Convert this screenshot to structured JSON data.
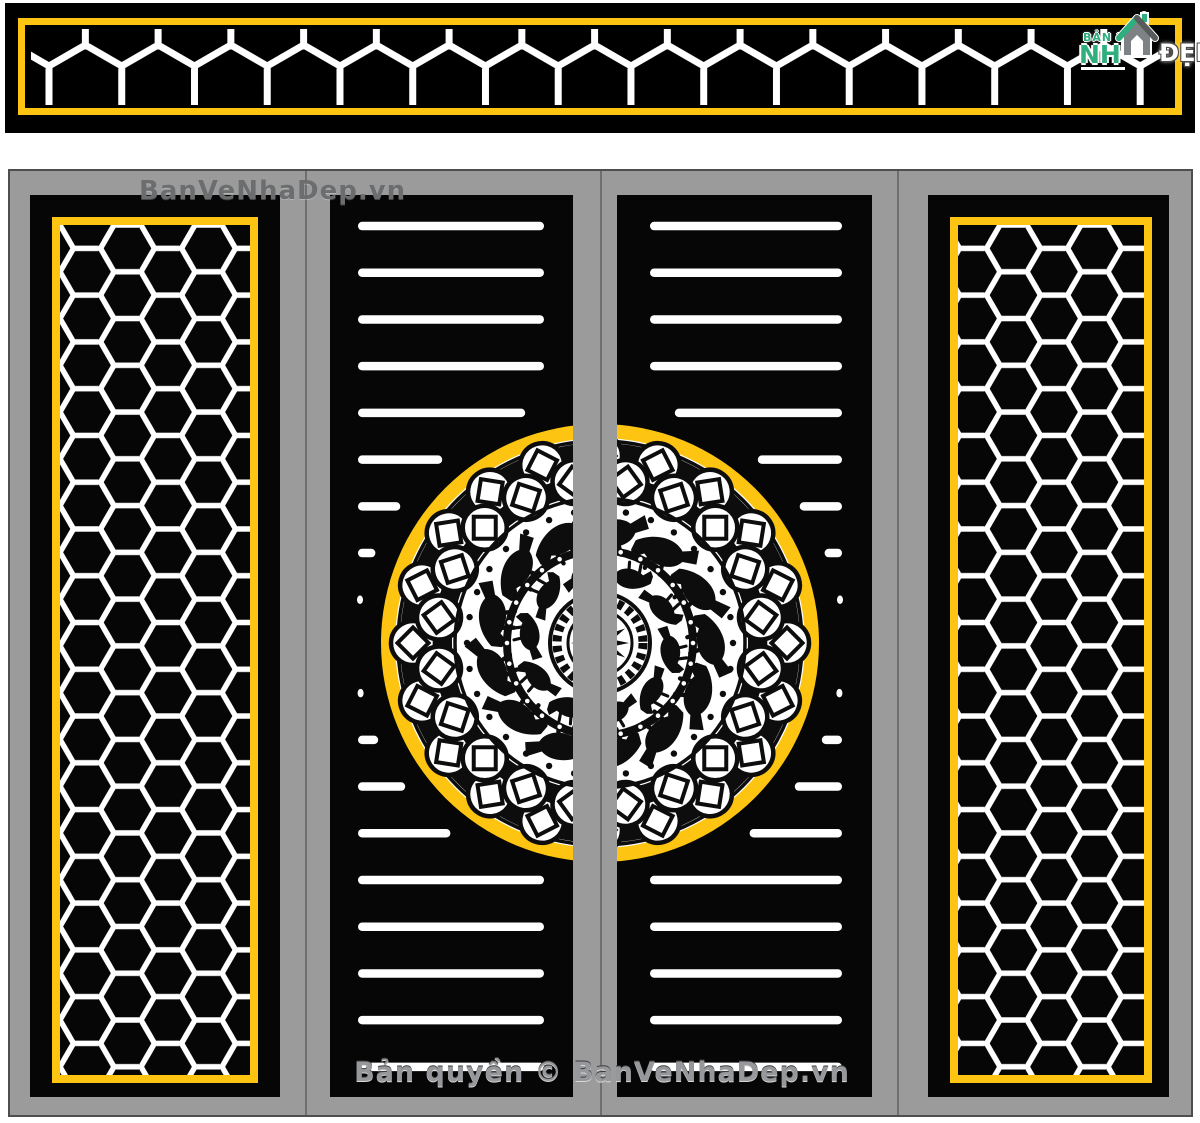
{
  "banner": {
    "description": "cube lattice cut pattern strip"
  },
  "logo": {
    "top_label": "BẢN VẼ",
    "main_label": "NH",
    "dep_label": "ĐẸP"
  },
  "gate": {
    "watermark": "BanVeNhaDep.vn",
    "copyright": "Bản quyền © BanVeNhaDep.vn"
  },
  "colors": {
    "accent_yellow": "#FDC411",
    "frame_gray": "#9B9B9B",
    "seam_gray": "#6F6F6F",
    "panel_black": "#060606",
    "cut_white": "#FFFFFF",
    "ornament_black": "#0D0D0D",
    "logo_teal": "#2FAE7E",
    "logo_house_gray": "#7F8284",
    "roof_dark": "#585B5C",
    "watermark_gray": "#6B6D6F",
    "copyright_gray": "#96989B"
  }
}
